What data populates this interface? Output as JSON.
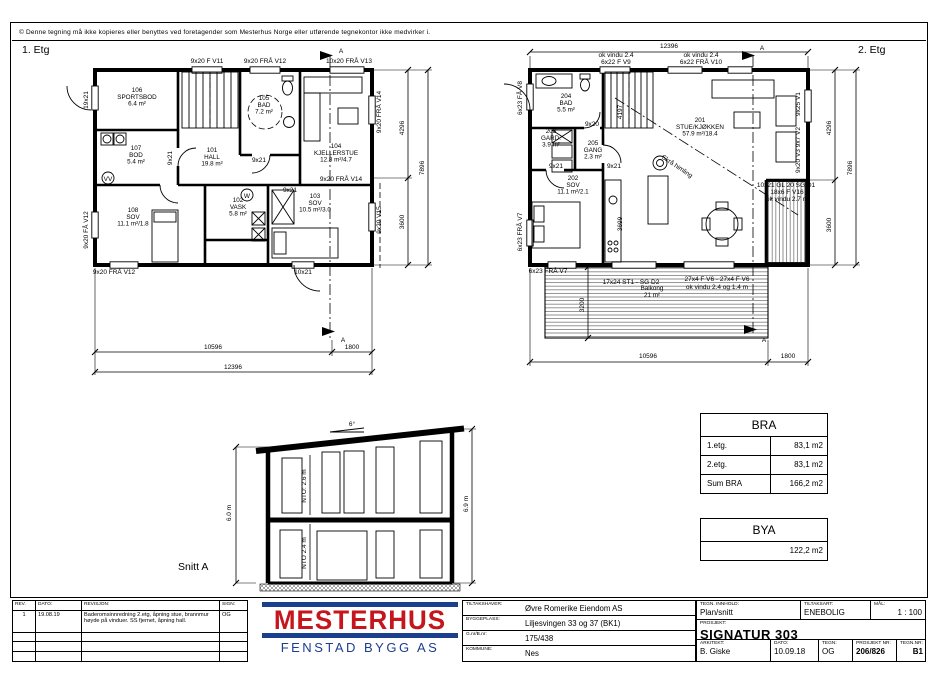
{
  "sheet": {
    "copyright": "© Denne tegning må ikke kopieres eller benyttes ved foretagender som Mesterhus Norge eller utførende tegnekontor ikke medvirker i."
  },
  "plans": {
    "floor1": {
      "title": "1. Etg",
      "rooms": [
        {
          "n": "106",
          "name": "SPORTSBOD",
          "area": "6.4 m²",
          "x": 137,
          "y": 92
        },
        {
          "n": "107",
          "name": "BOD",
          "area": "5.4 m²",
          "x": 136,
          "y": 150
        },
        {
          "n": "101",
          "name": "HALL",
          "area": "19.8 m²",
          "x": 212,
          "y": 152
        },
        {
          "n": "105",
          "name": "BAD",
          "area": "7.2 m²",
          "x": 264,
          "y": 100
        },
        {
          "n": "104",
          "name": "KJELLERSTUE",
          "area": "12.8 m²/4.7",
          "x": 336,
          "y": 148
        },
        {
          "n": "108",
          "name": "SOV",
          "area": "11.1 m²/1.8",
          "x": 133,
          "y": 212
        },
        {
          "n": "102",
          "name": "VASK",
          "area": "5.8 m²",
          "x": 238,
          "y": 202
        },
        {
          "n": "103",
          "name": "SOV",
          "area": "10.5 m²/3.0",
          "x": 315,
          "y": 198
        }
      ],
      "labels": [
        {
          "t": "9x20 F V11",
          "x": 207,
          "y": 63,
          "s": 5
        },
        {
          "t": "9x20 FRÅ V12",
          "x": 265,
          "y": 63,
          "s": 5
        },
        {
          "t": "10x20 FRÅ V13",
          "x": 349,
          "y": 63,
          "s": 5
        },
        {
          "t": "9x20 FRÅ V14",
          "x": 381,
          "y": 112,
          "r": -90,
          "s": 5
        },
        {
          "t": "9x20 FRÅ V14",
          "x": 341,
          "y": 181,
          "s": 4.6
        },
        {
          "t": "9x20 V15",
          "x": 381,
          "y": 220,
          "r": -90,
          "s": 5
        },
        {
          "t": "19x21",
          "x": 88,
          "y": 100,
          "r": -90,
          "s": 5
        },
        {
          "t": "9x20 FÅ V12",
          "x": 88,
          "y": 230,
          "r": -90,
          "s": 5
        },
        {
          "t": "9x20 FRÅ V12",
          "x": 114,
          "y": 274,
          "s": 5
        },
        {
          "t": "10x21",
          "x": 303,
          "y": 274,
          "s": 5
        },
        {
          "t": "9x21",
          "x": 172,
          "y": 158,
          "r": -90,
          "s": 4.6
        },
        {
          "t": "9x21",
          "x": 259,
          "y": 162,
          "s": 4.6
        },
        {
          "t": "9x21",
          "x": 290,
          "y": 192,
          "s": 4.6
        },
        {
          "t": "VV",
          "x": 108,
          "y": 181,
          "s": 4
        },
        {
          "t": "W",
          "x": 247,
          "y": 198,
          "s": 4
        },
        {
          "t": "10596",
          "x": 213,
          "y": 349
        },
        {
          "t": "1800",
          "x": 352,
          "y": 349
        },
        {
          "t": "12396",
          "x": 233,
          "y": 369
        },
        {
          "t": "4296",
          "x": 404,
          "y": 128,
          "r": -90
        },
        {
          "t": "3600",
          "x": 404,
          "y": 222,
          "r": -90
        },
        {
          "t": "7896",
          "x": 424,
          "y": 168,
          "r": -90
        },
        {
          "t": "A",
          "x": 341,
          "y": 53,
          "s": 8
        },
        {
          "t": "A",
          "x": 343,
          "y": 342,
          "s": 8
        }
      ]
    },
    "floor2": {
      "title": "2. Etg",
      "rooms": [
        {
          "n": "204",
          "name": "BAD",
          "area": "5.5 m²",
          "x": 566,
          "y": 98
        },
        {
          "n": "203",
          "name": "GARD.",
          "area": "3.9 m²",
          "x": 551,
          "y": 133
        },
        {
          "n": "205",
          "name": "GANG",
          "area": "2.3 m²",
          "x": 593,
          "y": 145
        },
        {
          "n": "202",
          "name": "SOV",
          "area": "11.1 m²/2.1",
          "x": 573,
          "y": 180
        },
        {
          "n": "201",
          "name": "STUE/KJØKKEN",
          "area": "57.9 m²/18.4",
          "x": 700,
          "y": 122
        },
        {
          "n": "",
          "name": "Balkong",
          "area": "21 m²",
          "x": 652,
          "y": 290
        }
      ],
      "labels": [
        {
          "t": "12396",
          "x": 669,
          "y": 48
        },
        {
          "t": "ok vindu 2.4",
          "x": 616,
          "y": 57,
          "s": 4.6
        },
        {
          "t": "6x22 F V9",
          "x": 616,
          "y": 64,
          "s": 4.6
        },
        {
          "t": "ok vindu 2.4",
          "x": 701,
          "y": 57,
          "s": 4.6
        },
        {
          "t": "6x22 FRÅ V10",
          "x": 701,
          "y": 64,
          "s": 4.6
        },
        {
          "t": "6x23 FÅ V8",
          "x": 522,
          "y": 98,
          "r": -90,
          "s": 5
        },
        {
          "t": "6x23 FRÅ V7",
          "x": 522,
          "y": 232,
          "r": -90,
          "s": 5
        },
        {
          "t": "6x23 FRÅ V7",
          "x": 548,
          "y": 273,
          "s": 4.6
        },
        {
          "t": "9x25 V1",
          "x": 800,
          "y": 104,
          "r": -90,
          "s": 5
        },
        {
          "t": "9x20 V3  9x7 V2",
          "x": 800,
          "y": 150,
          "r": -90,
          "s": 4.6
        },
        {
          "t": "10x21 GL 20 SG D1",
          "x": 786,
          "y": 187,
          "s": 4.4
        },
        {
          "t": "18x6 F V16",
          "x": 787,
          "y": 194,
          "s": 4.4
        },
        {
          "t": "ok vindu 2.7 m",
          "x": 787,
          "y": 201,
          "s": 4.4
        },
        {
          "t": "17x24 ST1 - SG D2",
          "x": 631,
          "y": 284,
          "s": 4.8
        },
        {
          "t": "27x4 F V6 - 27x4 F V6",
          "x": 717,
          "y": 281,
          "s": 4.8
        },
        {
          "t": "ok vindu 2.4 og 1.4 m",
          "x": 717,
          "y": 289,
          "s": 4.8
        },
        {
          "t": "4197",
          "x": 622,
          "y": 112,
          "r": -90,
          "s": 5.5
        },
        {
          "t": "3699",
          "x": 622,
          "y": 224,
          "r": -90,
          "s": 5.5
        },
        {
          "t": "Skrå himling",
          "x": 676,
          "y": 168,
          "r": 34,
          "s": 6
        },
        {
          "t": "9x20",
          "x": 592,
          "y": 126,
          "s": 4.6
        },
        {
          "t": "9x21",
          "x": 556,
          "y": 168,
          "s": 4.6
        },
        {
          "t": "9x21",
          "x": 614,
          "y": 168,
          "s": 4.6
        },
        {
          "t": "3200",
          "x": 584,
          "y": 305,
          "r": -90
        },
        {
          "t": "10596",
          "x": 648,
          "y": 358
        },
        {
          "t": "1800",
          "x": 788,
          "y": 358
        },
        {
          "t": "4296",
          "x": 831,
          "y": 128,
          "r": -90
        },
        {
          "t": "3600",
          "x": 831,
          "y": 225,
          "r": -90
        },
        {
          "t": "7896",
          "x": 852,
          "y": 168,
          "r": -90
        },
        {
          "t": "A",
          "x": 762,
          "y": 50,
          "s": 8
        },
        {
          "t": "A",
          "x": 764,
          "y": 342,
          "s": 8
        }
      ]
    }
  },
  "section": {
    "title": "Snitt A",
    "labels": [
      {
        "t": "6°",
        "x": 352,
        "y": 426,
        "s": 6.5
      },
      {
        "t": "NTO: 2.6 m",
        "x": 306,
        "y": 486,
        "r": -90,
        "s": 6.5
      },
      {
        "t": "NTO 2.4 m",
        "x": 306,
        "y": 553,
        "r": -90,
        "s": 6.5
      },
      {
        "t": "6.0 m",
        "x": 231,
        "y": 513,
        "r": -90,
        "s": 6.5
      },
      {
        "t": "6.9 m",
        "x": 468,
        "y": 504,
        "r": -90,
        "s": 6.5
      }
    ]
  },
  "bra": {
    "title": "BRA",
    "rows": [
      [
        "1.etg.",
        "83,1 m2"
      ],
      [
        "2.etg.",
        "83,1 m2"
      ],
      [
        "Sum BRA",
        "166,2 m2"
      ]
    ]
  },
  "bya": {
    "title": "BYA",
    "value": "122,2 m2"
  },
  "titleblock": {
    "rev": {
      "headers": [
        "REV.",
        "DATO:",
        "REVISJON:",
        "SIGN:"
      ],
      "row": {
        "rev": "1",
        "dato": "19.08.19",
        "text": "Baderomsinnredning 2.etg, åpning stue, brannmur høyde på vinduer. SS fjernet, åpning hall.",
        "sign": "OG"
      }
    },
    "logo": {
      "word": "MESTERHUS",
      "sub": "FENSTAD BYGG AS"
    },
    "project_info": [
      {
        "label": "TILTAKSHAVER:",
        "value": "Øvre Romerike Eiendom AS"
      },
      {
        "label": "BYGGEPLASS:",
        "value": "Liljesvingen 33 og 37 (BK1)"
      },
      {
        "label": "G.nr/B.nr:",
        "value": "175/438"
      },
      {
        "label": "KOMMUNE:",
        "value": "Nes"
      }
    ],
    "drawing_info": {
      "tegn_innhold_label": "TEGN. INNHOLD:",
      "tegn_innhold": "Plan/snitt",
      "tiltaksart_label": "TILTAKSART:",
      "tiltaksart": "ENEBOLIG",
      "maal_label": "MÅL:",
      "maal": "1 : 100",
      "prosjekt_label": "PROSJEKT:",
      "prosjekt": "SIGNATUR 303",
      "arkitekt_label": "ARKITEKT:",
      "arkitekt": "B. Giske",
      "dato_label": "DATO:",
      "dato": "10.09.18",
      "tegn_label": "TEGN:",
      "tegn": "OG",
      "prosjektnr_label": "PROSJEKT NR:",
      "prosjektnr": "206/826",
      "tegnnr_label": "TEGN.NR:",
      "tegnnr": "B1"
    }
  }
}
